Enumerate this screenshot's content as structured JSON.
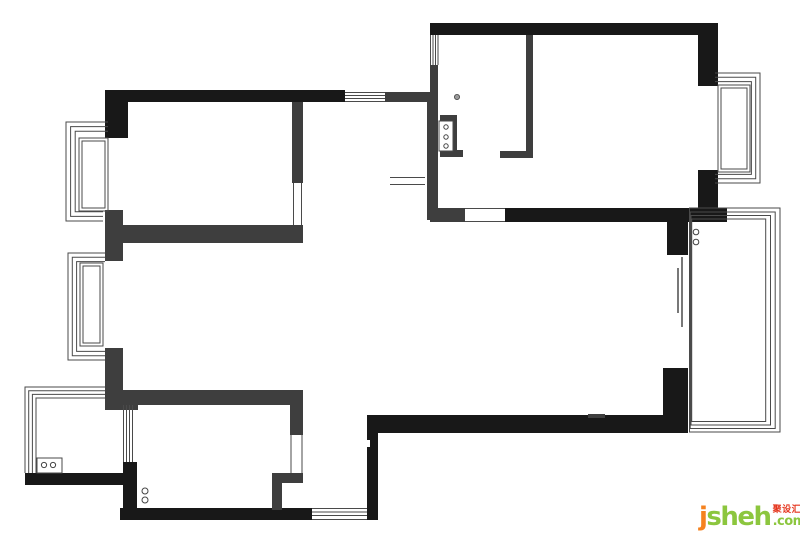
{
  "canvas": {
    "width": 800,
    "height": 541,
    "background": "#ffffff"
  },
  "palette": {
    "wall_black": "#181818",
    "wall_gray": "#3e3e3e",
    "line": "#4a4a4a",
    "circle_stroke": "#444444",
    "dot_fill": "#9a9a9a"
  },
  "floorplan": {
    "walls_black": [
      [
        105,
        90,
        240,
        12
      ],
      [
        105,
        90,
        23,
        48
      ],
      [
        430,
        23,
        288,
        12
      ],
      [
        698,
        23,
        20,
        63
      ],
      [
        698,
        170,
        20,
        52
      ],
      [
        505,
        208,
        222,
        14
      ],
      [
        667,
        222,
        21,
        33
      ],
      [
        663,
        368,
        25,
        65
      ],
      [
        378,
        415,
        310,
        18
      ],
      [
        367,
        415,
        11,
        105
      ],
      [
        120,
        508,
        192,
        12
      ],
      [
        123,
        462,
        14,
        58
      ],
      [
        25,
        473,
        98,
        12
      ]
    ],
    "walls_gray": [
      [
        385,
        92,
        42,
        10
      ],
      [
        430,
        65,
        8,
        30
      ],
      [
        427,
        92,
        11,
        128
      ],
      [
        292,
        102,
        11,
        81
      ],
      [
        105,
        225,
        198,
        18
      ],
      [
        105,
        210,
        18,
        51
      ],
      [
        105,
        348,
        18,
        55
      ],
      [
        107,
        390,
        196,
        15
      ],
      [
        290,
        390,
        13,
        45
      ],
      [
        272,
        473,
        31,
        10
      ],
      [
        272,
        473,
        10,
        37
      ],
      [
        430,
        208,
        35,
        14
      ],
      [
        526,
        35,
        7,
        123
      ],
      [
        500,
        151,
        26,
        7
      ],
      [
        105,
        390,
        33,
        20
      ],
      [
        588,
        414,
        17,
        4
      ],
      [
        440,
        115,
        17,
        7
      ],
      [
        452,
        115,
        5,
        42
      ],
      [
        440,
        150,
        23,
        7
      ]
    ],
    "window_lines": [
      [
        345,
        92.5,
        385,
        92.5
      ],
      [
        345,
        95.5,
        385,
        95.5
      ],
      [
        345,
        98.5,
        385,
        98.5
      ],
      [
        345,
        101.5,
        385,
        101.5
      ],
      [
        430.5,
        35,
        430.5,
        65
      ],
      [
        433,
        35,
        433,
        65
      ],
      [
        435.5,
        35,
        435.5,
        65
      ],
      [
        438,
        35,
        438,
        65
      ],
      [
        312,
        508.5,
        367,
        508.5
      ],
      [
        312,
        512,
        367,
        512
      ],
      [
        312,
        515.5,
        367,
        515.5
      ],
      [
        312,
        519.5,
        367,
        519.5
      ],
      [
        123.5,
        405,
        123.5,
        462
      ],
      [
        126.5,
        405,
        126.5,
        462
      ],
      [
        129.5,
        405,
        129.5,
        462
      ],
      [
        132.5,
        405,
        132.5,
        462
      ],
      [
        291,
        435,
        291,
        473
      ],
      [
        302,
        435,
        302,
        473
      ],
      [
        293.5,
        183,
        293.5,
        225
      ],
      [
        301.5,
        183,
        301.5,
        225
      ],
      [
        390,
        177.5,
        425,
        177.5
      ],
      [
        390,
        184.5,
        425,
        184.5
      ],
      [
        465,
        208.5,
        505,
        208.5
      ],
      [
        465,
        221.5,
        505,
        221.5
      ]
    ],
    "slider_lines": [
      [
        678,
        268,
        678,
        313
      ],
      [
        682,
        257,
        682,
        327
      ]
    ],
    "frame_paths": [
      [
        [
          105,
          387
        ],
        [
          25,
          387
        ],
        [
          25,
          473
        ]
      ],
      [
        [
          105,
          390.7
        ],
        [
          28.7,
          390.7
        ],
        [
          28.7,
          473
        ]
      ],
      [
        [
          105,
          394.4
        ],
        [
          32.4,
          394.4
        ],
        [
          32.4,
          473
        ]
      ],
      [
        [
          105,
          398
        ],
        [
          36,
          398
        ],
        [
          36,
          473
        ]
      ],
      [
        [
          108,
          122
        ],
        [
          66,
          122
        ],
        [
          66,
          221
        ],
        [
          103,
          221
        ]
      ],
      [
        [
          108,
          126.6
        ],
        [
          70.6,
          126.6
        ],
        [
          70.6,
          216.4
        ],
        [
          103,
          216.4
        ]
      ],
      [
        [
          108,
          131.2
        ],
        [
          75.2,
          131.2
        ],
        [
          75.2,
          211.8
        ],
        [
          103,
          211.8
        ]
      ],
      [
        [
          105,
          253
        ],
        [
          68,
          253
        ],
        [
          68,
          360
        ],
        [
          105,
          360
        ]
      ],
      [
        [
          105,
          257.3
        ],
        [
          72.3,
          257.3
        ],
        [
          72.3,
          355.7
        ],
        [
          105,
          355.7
        ]
      ],
      [
        [
          105,
          261.6
        ],
        [
          76.6,
          261.6
        ],
        [
          76.6,
          351.4
        ],
        [
          105,
          351.4
        ]
      ],
      [
        [
          715,
          73
        ],
        [
          760,
          73
        ],
        [
          760,
          183
        ],
        [
          715,
          183
        ]
      ],
      [
        [
          715,
          77.3
        ],
        [
          755.7,
          77.3
        ],
        [
          755.7,
          178.7
        ],
        [
          715,
          178.7
        ]
      ],
      [
        [
          715,
          81.6
        ],
        [
          751.4,
          81.6
        ],
        [
          751.4,
          174.4
        ],
        [
          715,
          174.4
        ]
      ]
    ],
    "rects_stroked": [
      [
        689.5,
        208,
        90.5,
        224
      ],
      [
        690.2,
        212,
        85,
        216.5
      ],
      [
        691,
        215.5,
        79.5,
        209.5
      ],
      [
        691.7,
        219,
        74,
        202.5
      ],
      [
        79,
        138,
        29,
        73
      ],
      [
        82,
        141,
        23,
        67
      ],
      [
        80,
        263,
        23,
        83
      ],
      [
        83,
        266,
        17,
        77
      ],
      [
        718,
        85,
        32,
        87
      ],
      [
        721,
        88,
        26,
        81
      ]
    ],
    "rects_white": [
      [
        439,
        121,
        14,
        30
      ],
      [
        37,
        458,
        25,
        15
      ]
    ],
    "white_marks": [
      [
        367,
        440,
        3,
        7
      ]
    ],
    "circles": [
      [
        696,
        232,
        2.8
      ],
      [
        696,
        242,
        2.8
      ],
      [
        145,
        491,
        3
      ],
      [
        145,
        500,
        3
      ],
      [
        446,
        127,
        2.2
      ],
      [
        446,
        137,
        2.2
      ],
      [
        446,
        146,
        2.2
      ],
      [
        44,
        465,
        2.6
      ],
      [
        53,
        465,
        2.6
      ]
    ],
    "dots": [
      [
        457,
        97,
        2.6
      ]
    ]
  },
  "watermark": {
    "brand_initial": "j",
    "brand_rest": "sheh",
    "brand_cn": "聚设汇",
    "brand_tld": ".com",
    "color_orange": "#f5821f",
    "color_green": "#8cc63e",
    "color_red": "#e5351d"
  }
}
